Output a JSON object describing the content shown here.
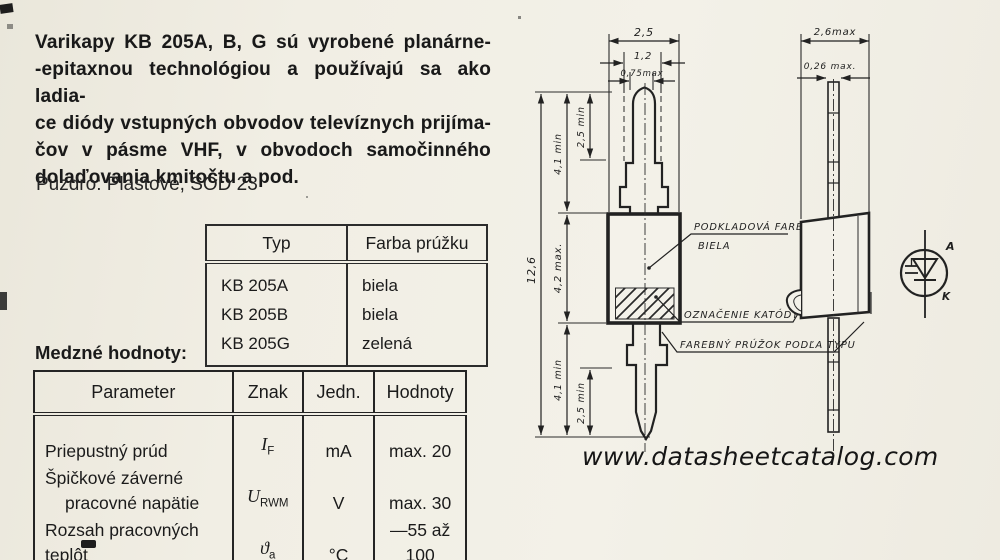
{
  "document": {
    "intro_lines": [
      "Varikapy KB 205A, B, G sú vyrobené planárne-",
      "-epitaxnou technológiou a používajú sa ako ladia-",
      "ce diódy vstupných obvodov televíznych prijíma-",
      "čov v pásme VHF, v obvodoch samočinného",
      "dolaďovania kmitočtu a pod."
    ],
    "package_note": "Puzdro: Plastové, SOD 23",
    "limits_heading": "Medzné hodnoty:",
    "watermark": "www.datasheetcatalog.com"
  },
  "type_table": {
    "headers": [
      "Typ",
      "Farba prúžku"
    ],
    "rows": [
      {
        "typ": "KB 205A",
        "farba": "biela"
      },
      {
        "typ": "KB 205B",
        "farba": "biela"
      },
      {
        "typ": "KB 205G",
        "farba": "zelená"
      }
    ]
  },
  "limits_table": {
    "headers": [
      "Parameter",
      "Znak",
      "Jedn.",
      "Hodnoty"
    ],
    "rows": [
      {
        "param": "Priepustný prúd",
        "znak_base": "I",
        "znak_sub": "F",
        "jedn": "mA",
        "hodnoty": "max. 20"
      },
      {
        "param_line1": "Špičkové záverné",
        "param_line2": "pracovné napätie",
        "znak_base": "U",
        "znak_sub": "RWM",
        "jedn": "V",
        "hodnoty": "max. 30"
      },
      {
        "param": "Rozsah pracovných teplôt",
        "znak_base": "ϑ",
        "znak_sub": "a",
        "jedn": "°C",
        "hodnoty": "—55 až 100"
      }
    ]
  },
  "drawing": {
    "front_view": {
      "width_dim": "2,5",
      "inner_width_dim": "1,2",
      "lead_width_dim": "0,75max",
      "overall_length_dim": "12,6",
      "lead_length_top_dim": "4,1 min",
      "lead_tip_top_dim": "2,5 min",
      "body_length_dim": "4,2 max.",
      "lead_length_bottom_dim": "4,1 min",
      "lead_tip_bottom_dim": "2,5 min"
    },
    "side_view": {
      "width_dim": "2,6max",
      "lead_thickness_dim": "0,26 max."
    },
    "callouts": {
      "base_color_line1": "PODKLADOVÁ FARBA",
      "base_color_line2": "BIELA",
      "cathode_mark": "OZNAČENIE KATÓDY",
      "color_stripe": "FAREBNÝ PRÚŽOK PODĽA TYPU"
    },
    "symbol": {
      "anode": "A",
      "cathode": "K"
    }
  }
}
